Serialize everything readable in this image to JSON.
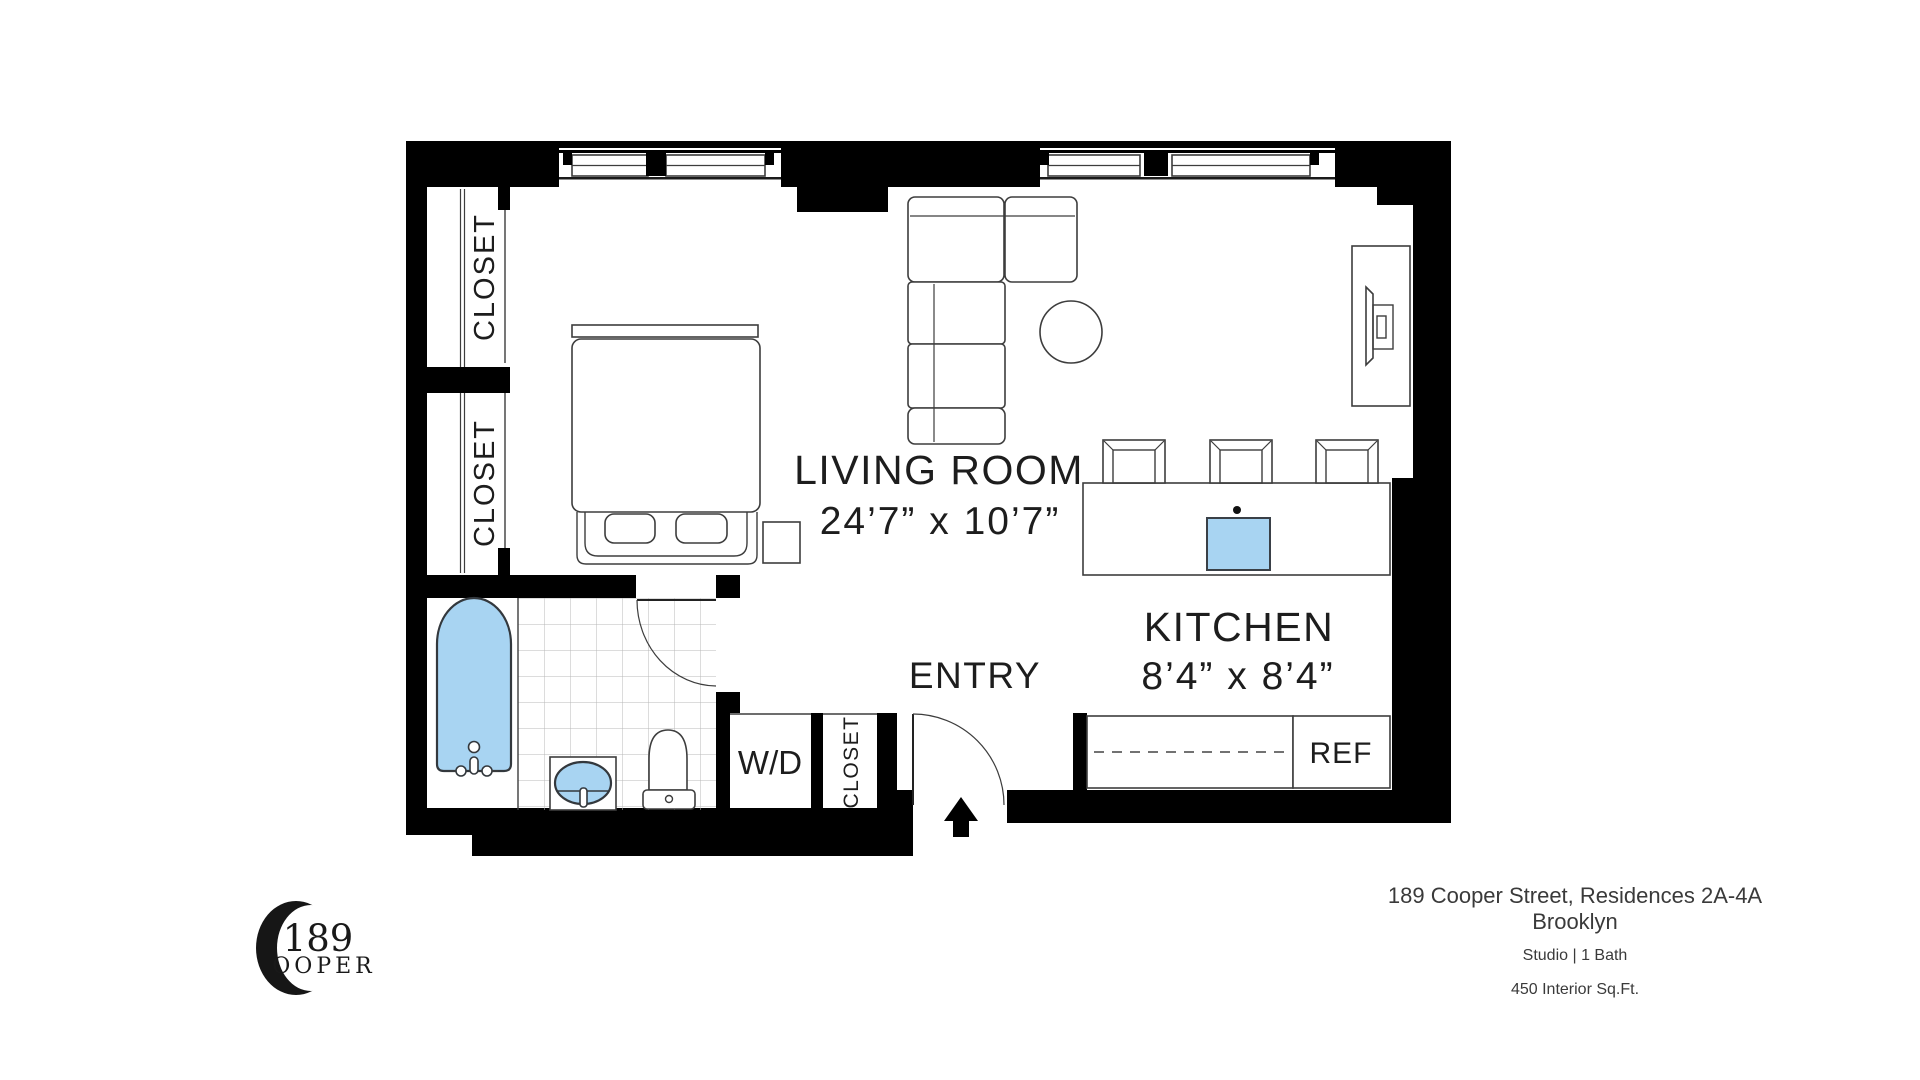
{
  "plan": {
    "living_room": {
      "label": "LIVING ROOM",
      "dimensions": "24’7” x 10’7”"
    },
    "kitchen": {
      "label": "KITCHEN",
      "dimensions": "8’4” x 8’4”"
    },
    "entry": {
      "label": "ENTRY"
    },
    "closet_upper": {
      "label": "CLOSET"
    },
    "closet_lower": {
      "label": "CLOSET"
    },
    "closet_entry": {
      "label": "CLOSET"
    },
    "washer_dryer": {
      "label": "W/D"
    },
    "refrigerator": {
      "label": "REF"
    }
  },
  "footer": {
    "address": "189 Cooper Street, Residences 2A-4A",
    "city": "Brooklyn",
    "unit_type": "Studio | 1 Bath",
    "area": "450 Interior Sq.Ft."
  },
  "logo": {
    "number": "189",
    "letters": "OOPER"
  },
  "colors": {
    "fixture_fill": "#a8d4f2",
    "fixture_stroke": "#3a4047",
    "wall": "#000000",
    "furniture_line": "#3d3d3d"
  }
}
